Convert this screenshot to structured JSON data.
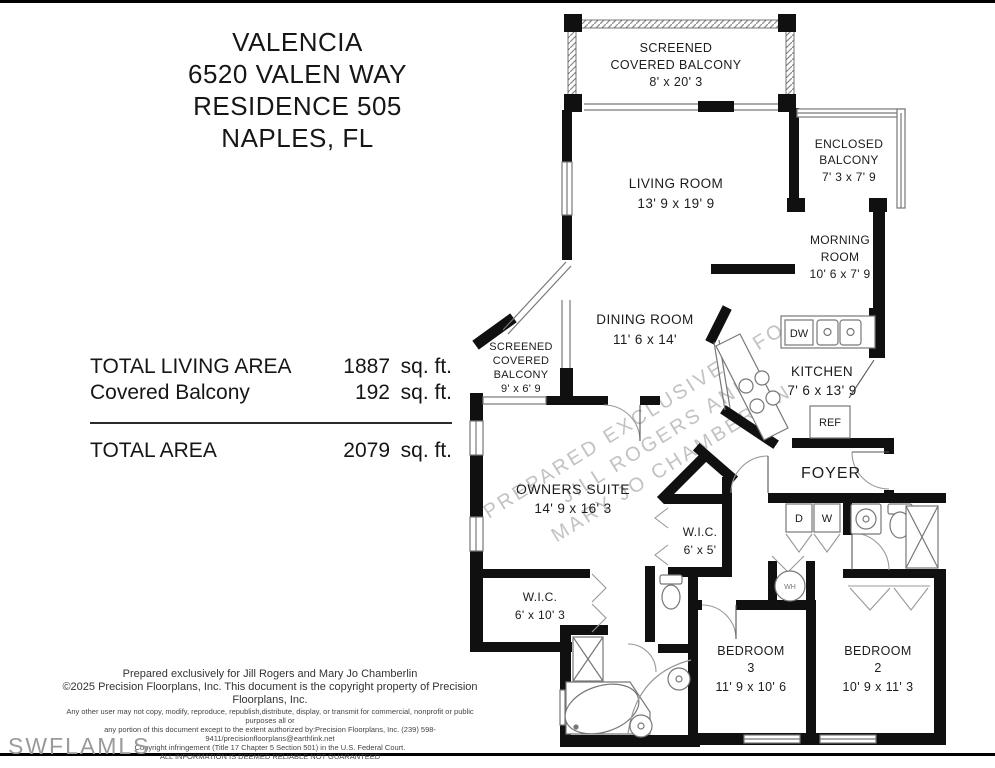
{
  "header": {
    "lines": [
      "VALENCIA",
      "6520 VALEN WAY",
      "RESIDENCE 505",
      "NAPLES, FL"
    ]
  },
  "area": {
    "living_label": "TOTAL LIVING AREA",
    "living_value": "1887",
    "living_unit": "sq. ft.",
    "balcony_label": "Covered Balcony",
    "balcony_value": "192",
    "balcony_unit": "sq. ft.",
    "total_label": "TOTAL AREA",
    "total_value": "2079",
    "total_unit": "sq. ft."
  },
  "rooms": {
    "balcony_top": [
      "SCREENED",
      "COVERED BALCONY",
      "8' x 20' 3"
    ],
    "living": [
      "LIVING ROOM",
      "13' 9 x 19' 9"
    ],
    "enclosed_balcony": [
      "ENCLOSED",
      "BALCONY",
      "7' 3 x 7' 9"
    ],
    "morning": [
      "MORNING",
      "ROOM",
      "10' 6 x 7' 9"
    ],
    "dining": [
      "DINING ROOM",
      "11' 6 x 14'"
    ],
    "kitchen": [
      "KITCHEN",
      "7' 6 x 13' 9"
    ],
    "balcony_left": [
      "SCREENED",
      "COVERED",
      "BALCONY",
      "9' x 6' 9"
    ],
    "foyer": [
      "FOYER"
    ],
    "owners": [
      "OWNERS SUITE",
      "14' 9 x 16' 3"
    ],
    "wic_small": [
      "W.I.C.",
      "6' x 5'"
    ],
    "wic_large": [
      "W.I.C.",
      "6' x 10' 3"
    ],
    "bedroom3": [
      "BEDROOM",
      "3",
      "11' 9 x 10' 6"
    ],
    "bedroom2": [
      "BEDROOM",
      "2",
      "10' 9 x 11' 3"
    ]
  },
  "fixtures": {
    "dishwasher": "DW",
    "refrigerator": "REF",
    "dryer": "D",
    "washer": "W",
    "water_heater": "WH"
  },
  "watermarks": {
    "diagonal": [
      "PREPARED EXCLUSIVELY FOR",
      "JILL ROGERS AND",
      "MARY JO CHAMBERLIN"
    ],
    "mls": "SWFLAMLS"
  },
  "footer": {
    "lines": [
      "Prepared exclusively for Jill Rogers and Mary Jo Chamberlin",
      "©2025 Precision Floorplans, Inc.  This document is the copyright property of Precision Floorplans, Inc.",
      "Any other user may not copy, modify, reproduce, republish,distribute, display, or transmit for commercial, nonprofit or public purposes all or",
      "any portion of this document except to the extent authorized by:Precision Floorplans, Inc. (239) 598-9411/precisionfloorplans@earthlink.net",
      "Copyright infringement (Title 17 Chapter 5 Section 501) in the U.S. Federal Court.",
      "ALL INFORMATION IS DEEMED RELIABLE NOT GUARANTEED"
    ]
  }
}
